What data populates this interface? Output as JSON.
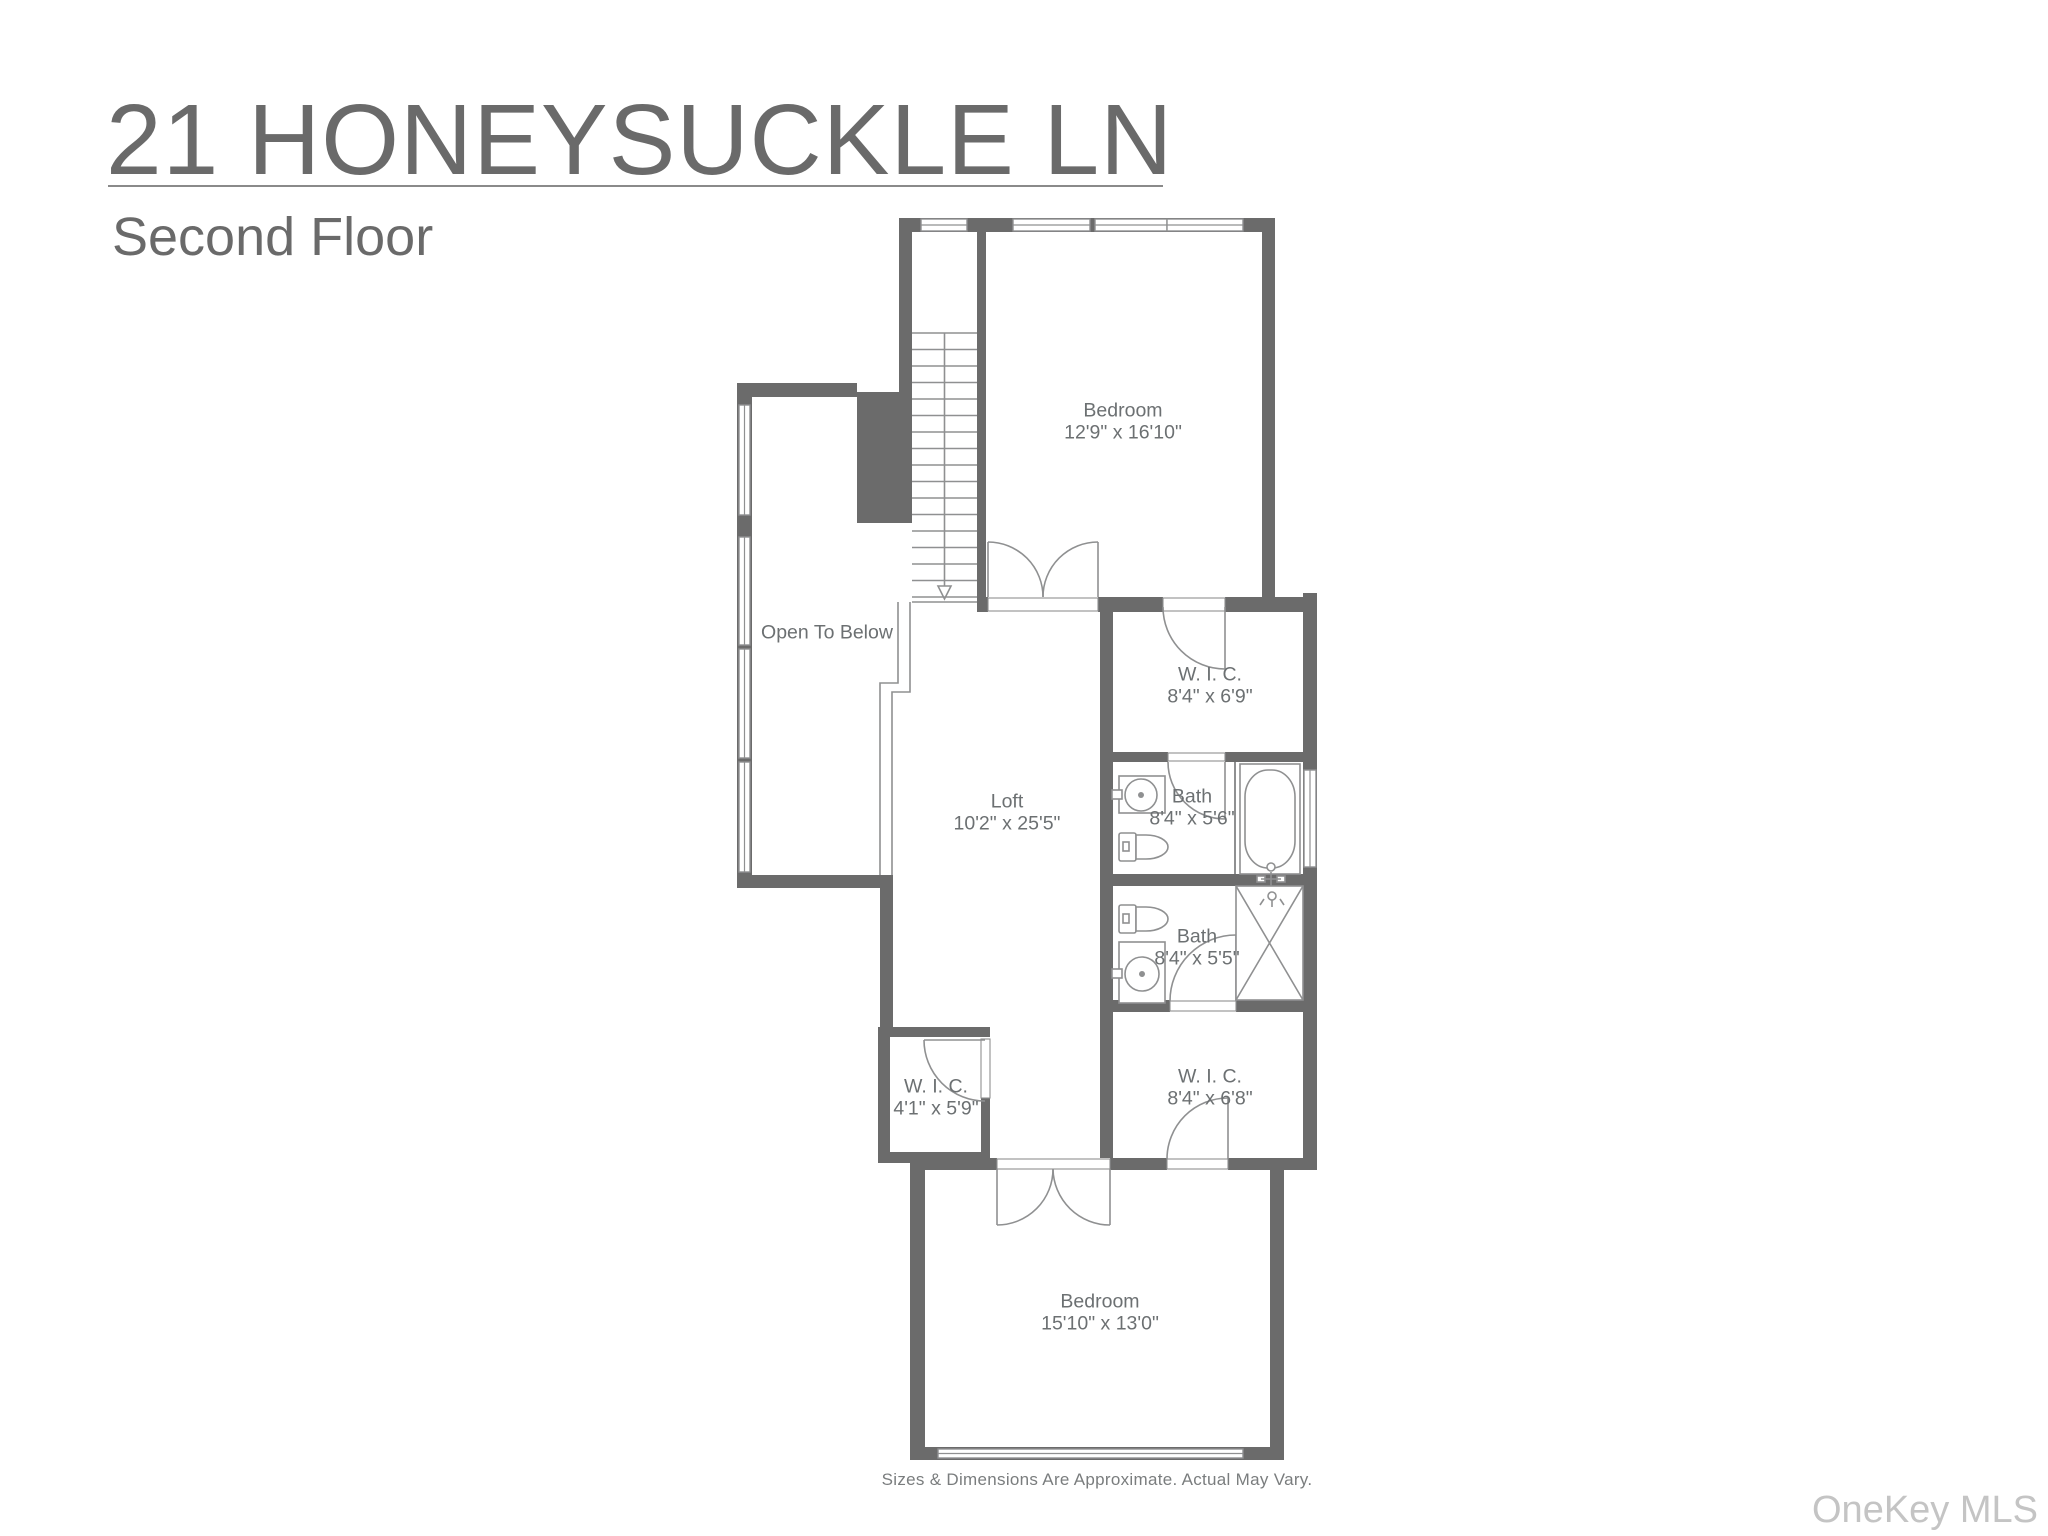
{
  "header": {
    "address": "21 HONEYSUCKLE LN",
    "floor": "Second Floor"
  },
  "rooms": {
    "bedroom_top": {
      "name": "Bedroom",
      "dims": "12'9\" x 16'10\""
    },
    "open_to_below": {
      "name": "Open To Below"
    },
    "wic_top": {
      "name": "W. I. C.",
      "dims": "8'4\" x 6'9\""
    },
    "loft": {
      "name": "Loft",
      "dims": "10'2\" x 25'5\""
    },
    "bath_upper": {
      "name": "Bath",
      "dims": "8'4\" x 5'6\""
    },
    "bath_lower": {
      "name": "Bath",
      "dims": "8'4\" x 5'5\""
    },
    "wic_small": {
      "name": "W. I. C.",
      "dims": "4'1\" x 5'9\""
    },
    "wic_bottom": {
      "name": "W. I. C.",
      "dims": "8'4\" x 6'8\""
    },
    "bedroom_bottom": {
      "name": "Bedroom",
      "dims": "15'10\" x 13'0\""
    }
  },
  "footer": {
    "disclaimer": "Sizes & Dimensions Are Approximate. Actual May Vary."
  },
  "watermark": {
    "label": "OneKey MLS"
  },
  "colors": {
    "wall": "#6b6b6b",
    "line": "#8f9091",
    "text": "#6c7072",
    "title": "#6a6a6a",
    "underline": "#8a8a8a",
    "watermark": "#c4c4c4"
  }
}
